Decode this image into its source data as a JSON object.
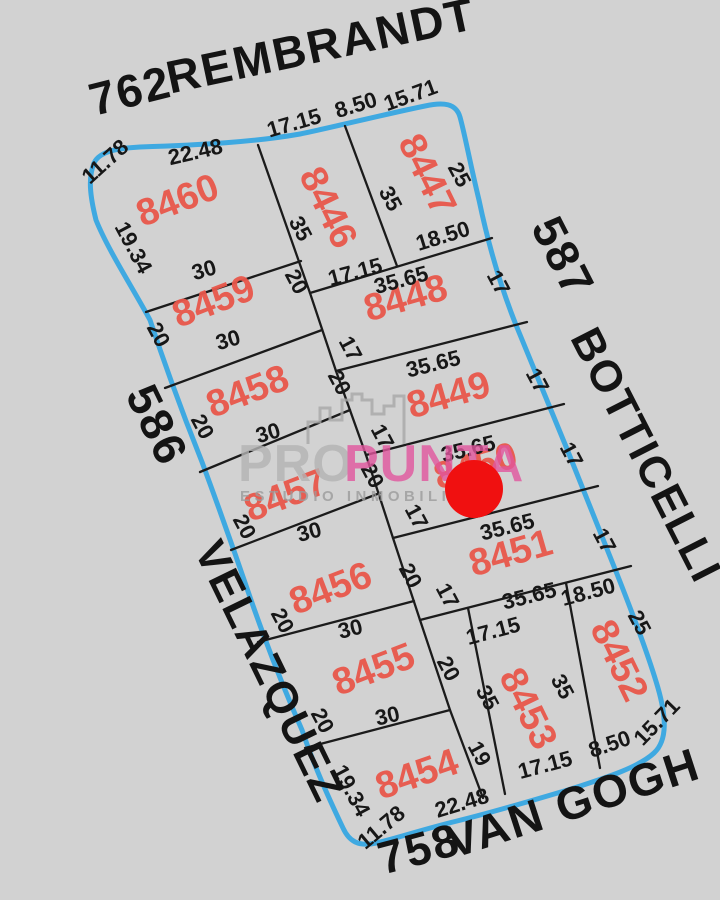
{
  "map": {
    "background_color": "#d2d2d2",
    "block_outline_color": "#3fa9e1",
    "lot_line_color": "#1b1b1b",
    "lot_number_color": "#e9574b",
    "dimension_color": "#171717"
  },
  "streets": {
    "top_number": "762",
    "top_name": "REMBRANDT",
    "right_number": "587",
    "right_name": "BOTTICELLI",
    "bottom_number": "758",
    "bottom_name": "VAN GOGH",
    "left_number": "586",
    "left_name": "VELAZQUEZ"
  },
  "lots": [
    {
      "number": "8446"
    },
    {
      "number": "8447"
    },
    {
      "number": "8448"
    },
    {
      "number": "8449"
    },
    {
      "number": "8450"
    },
    {
      "number": "8451"
    },
    {
      "number": "8452"
    },
    {
      "number": "8453"
    },
    {
      "number": "8454"
    },
    {
      "number": "8455"
    },
    {
      "number": "8456"
    },
    {
      "number": "8457"
    },
    {
      "number": "8458"
    },
    {
      "number": "8459"
    },
    {
      "number": "8460"
    }
  ],
  "dims": [
    {
      "v": "11.78"
    },
    {
      "v": "22.48"
    },
    {
      "v": "17.15"
    },
    {
      "v": "8.50"
    },
    {
      "v": "15.71"
    },
    {
      "v": "19.34"
    },
    {
      "v": "20"
    },
    {
      "v": "20"
    },
    {
      "v": "20"
    },
    {
      "v": "20"
    },
    {
      "v": "20"
    },
    {
      "v": "19.34"
    },
    {
      "v": "11.78"
    },
    {
      "v": "22.48"
    },
    {
      "v": "17.15"
    },
    {
      "v": "8.50"
    },
    {
      "v": "15.71"
    },
    {
      "v": "25"
    },
    {
      "v": "17"
    },
    {
      "v": "17"
    },
    {
      "v": "17"
    },
    {
      "v": "17"
    },
    {
      "v": "25"
    },
    {
      "v": "35"
    },
    {
      "v": "35"
    },
    {
      "v": "20"
    },
    {
      "v": "17"
    },
    {
      "v": "20"
    },
    {
      "v": "17"
    },
    {
      "v": "20"
    },
    {
      "v": "17"
    },
    {
      "v": "20"
    },
    {
      "v": "17"
    },
    {
      "v": "20"
    },
    {
      "v": "35"
    },
    {
      "v": "19"
    },
    {
      "v": "35"
    },
    {
      "v": "30"
    },
    {
      "v": "30"
    },
    {
      "v": "30"
    },
    {
      "v": "30"
    },
    {
      "v": "30"
    },
    {
      "v": "30"
    },
    {
      "v": "18.50"
    },
    {
      "v": "17.15"
    },
    {
      "v": "35.65"
    },
    {
      "v": "35.65"
    },
    {
      "v": "35.65"
    },
    {
      "v": "35.65"
    },
    {
      "v": "35.65"
    },
    {
      "v": "18.50"
    },
    {
      "v": "17.15"
    }
  ],
  "watermark": {
    "brand_prefix": "PRO",
    "brand_suffix": "PUNTA",
    "tagline": "ESTUDIO INMOBILIARIO",
    "prefix_color": "#b4b4b4",
    "suffix_color": "#e2569e",
    "tagline_color": "#9c9c9c"
  },
  "marker": {
    "color": "#f01010"
  }
}
